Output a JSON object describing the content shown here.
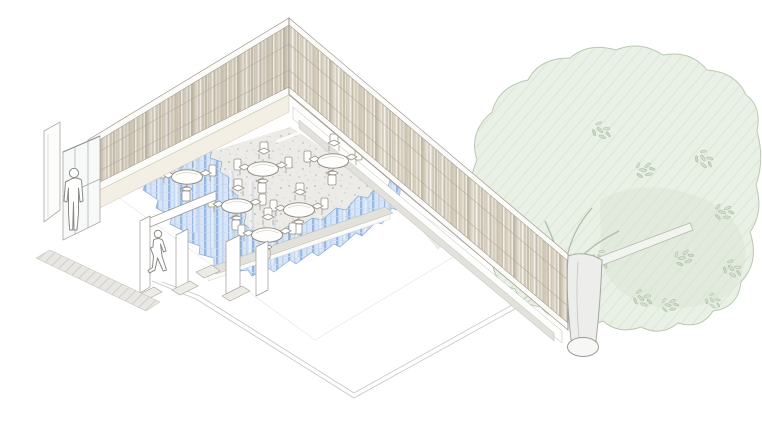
{
  "figure": {
    "kind": "architectural-axonometric-drawing",
    "description": "Cutaway axonometric of a pavilion dining room with slatted screen walls, a wavy blue curtain band, round tables with chairs, entry doors with two human figures, and a large tree"
  },
  "colors": {
    "background": "#ffffff",
    "stipple_floor": "#ecebe7",
    "stipple_dot": "#c9c8c2",
    "curtain_base": "#d7e4f6",
    "curtain_stripe": "#93b6e4",
    "curtain_stripe2": "#bcd2ee",
    "curtain_gridline": "#c6d9f2",
    "curtain_edge": "#86a9d8",
    "foliage_fill": "#e9f0e5",
    "foliage_shade": "#dfe9d9",
    "foliage_line": "#b9c8b2",
    "leaf_fill": "#d3e0cd",
    "leaf_line": "#9fb29a",
    "trunk_fill": "#ededeb",
    "trunk_line": "#a5a5a0",
    "slat_a": "#d7cfbf",
    "slat_b": "#c2b9a6",
    "slat_c": "#efece4",
    "cream_band": "#f3efe4",
    "fascia_gray": "#e2e1dc",
    "walkway_hatch_base": "#e8e7e3",
    "walkway_hatch_line": "#cfcec8",
    "outline_gray": "#9a9488"
  },
  "scene": {
    "screen_walls": {
      "count": 2,
      "corner_apex": [
        289,
        18
      ]
    },
    "tables": {
      "count": 6,
      "chairs_per_table": 4,
      "positions": [
        [
          187,
          177
        ],
        [
          263,
          169
        ],
        [
          333,
          161
        ],
        [
          237,
          206
        ],
        [
          299,
          210
        ],
        [
          267,
          235
        ]
      ]
    },
    "people": {
      "count": 2,
      "figures": [
        {
          "kind": "standing",
          "x": 74,
          "y": 230
        },
        {
          "kind": "walking",
          "x": 158,
          "y": 268
        }
      ]
    },
    "tree": {
      "count": 1,
      "trunk_base_x": 583,
      "trunk_base_y": 347
    },
    "curtain": {
      "shape": "L-shaped wavy band",
      "sides": [
        "west",
        "south"
      ]
    },
    "entry": {
      "door_leaves": 1,
      "glass_panels": 3
    },
    "ground_slab": {
      "outline_vertex": [
        354,
        398
      ]
    }
  }
}
